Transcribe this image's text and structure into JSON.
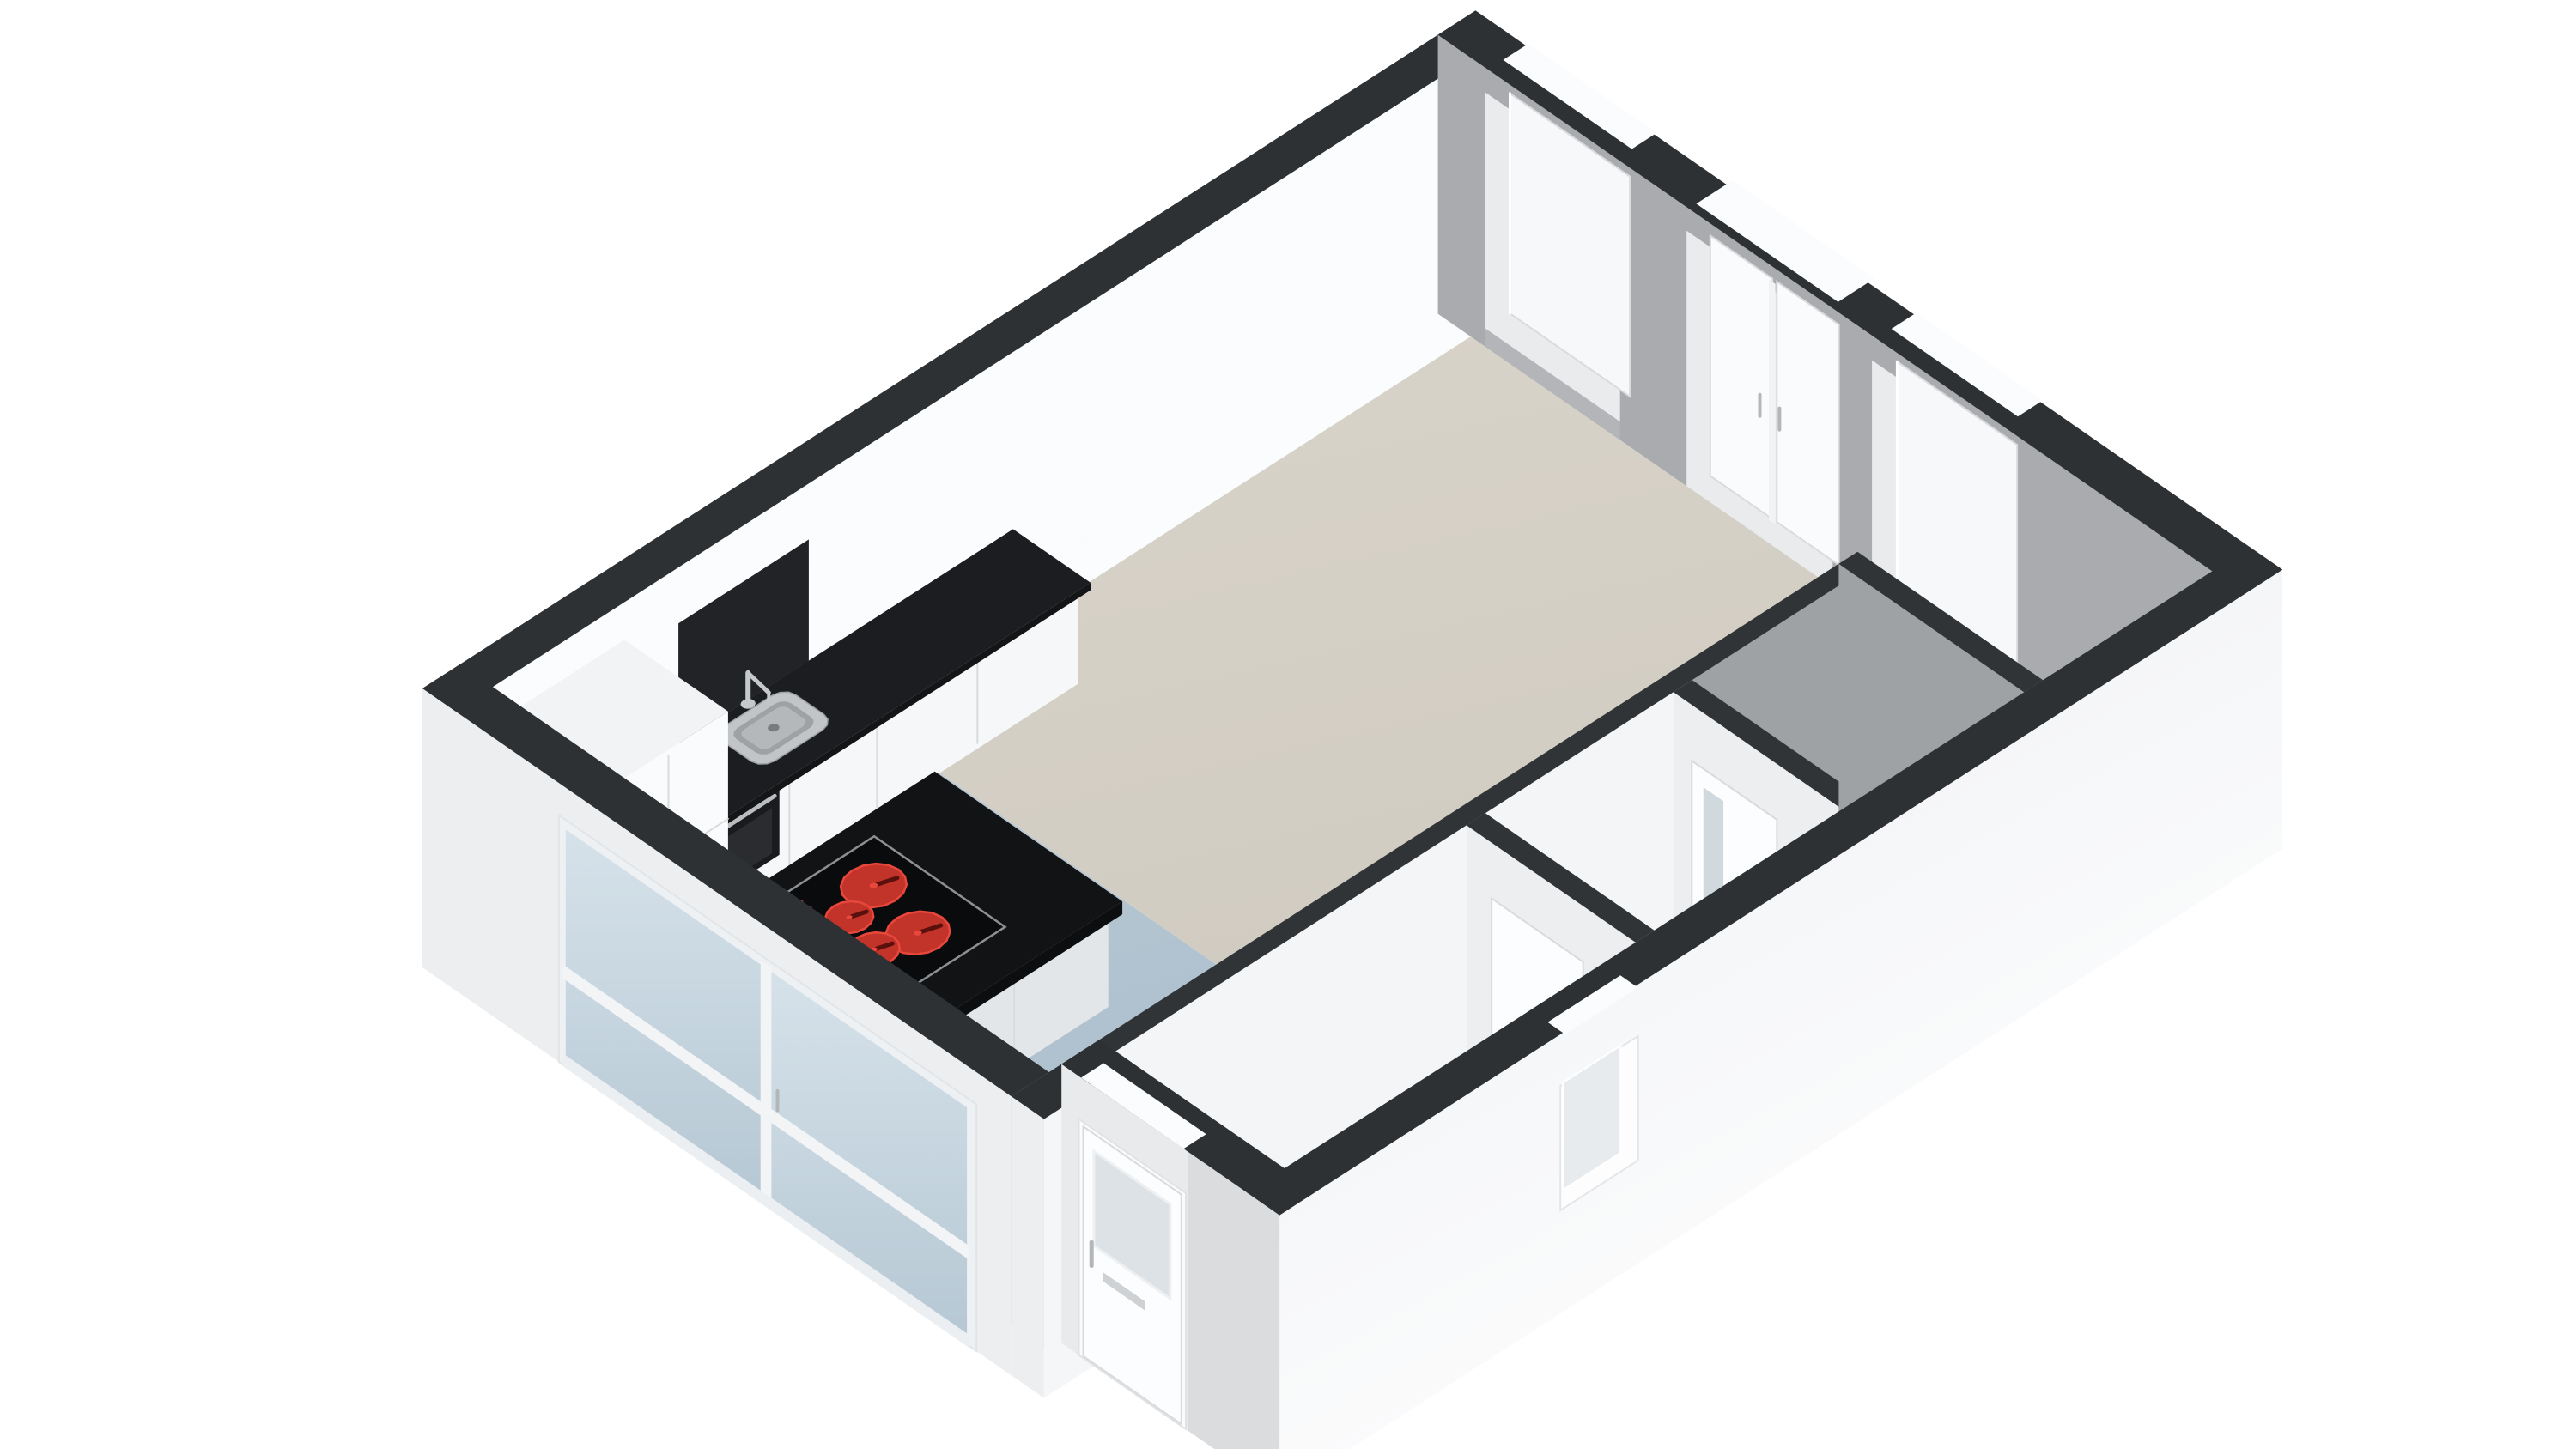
{
  "scene": {
    "type": "3d-floorplan-render",
    "description": "Isometric 3D floor plan of a studio apartment, empty of furniture, white background",
    "rooms": [
      "living-room",
      "kitchen",
      "entrance-hall",
      "toilet",
      "bathroom",
      "alcove"
    ],
    "fixtures": [
      "kitchen-island",
      "ceramic-cooktop",
      "sink",
      "faucet",
      "built-in-oven",
      "kitchen-counter",
      "tall-cabinet",
      "washing-machine",
      "low-cabinet"
    ],
    "openings": [
      "entrance-door",
      "sliding-glass-doors",
      "french-doors",
      "window-1",
      "window-2",
      "small-window",
      "interior-door-1",
      "interior-door-2"
    ]
  },
  "colors": {
    "background": "#ffffff",
    "cap": "#2e3133",
    "capInt": "#313437",
    "extWhiteF": "#eceef0",
    "extLightE": "#f4f6f8",
    "extDoorWallD": "#e8eaec",
    "doorWallShade": "#dadcde",
    "innerWhiteA": "#fbfcfd",
    "grayInner": "#a9abae",
    "grayPanel": "#b3b5b8",
    "grayBath": "#9fa2a5",
    "intWhiteG": "#f4f5f7",
    "intWhite2": "#eceef0",
    "living1": "#d9d4ca",
    "living2": "#cfcabf",
    "kitchen1": "#bccbd6",
    "kitchen2": "#a9bdcb",
    "floorHall": "#e8e7e3",
    "floorToilet": "#edeeef",
    "floorBath": "#eaecee",
    "wallC1": "#edeff2",
    "wallC2": "#ffffff",
    "counterBlack": "#1c1d20",
    "counterEdge": "#141517",
    "backsplash": "#212326",
    "cabWhite": "#f6f7f9",
    "cabSeam": "#d9dbde",
    "cabEnd": "#e8eaec",
    "tallTop": "#f2f3f5",
    "tallFace": "#fafbfc",
    "tallSide": "#e7e9eb",
    "islandTop": "#121315",
    "islandEdgeX": "#0d0e10",
    "islandEdgeY": "#17181b",
    "islandFaceX": "#e3e6e9",
    "islandFaceY": "#f5f6f8",
    "cooktop": "#0a0b0d",
    "cooktopFrame": "#8d9093",
    "burner": "#c2332a",
    "burnerRing": "#e8473c",
    "burnerDark": "#5a110d",
    "steel": "#c2c5c8",
    "steelDark": "#9ea2a5",
    "drain": "#787c7f",
    "faucet": "#c6c9cc",
    "oven": "#1a1b1e",
    "ovenGlass": "#2a2c30",
    "ovenHandle": "#babdc0",
    "doorWhite": "#fcfdfe",
    "doorStroke": "#d8dadd",
    "frost": "#dde2e6",
    "letterbox": "#cfd2d4",
    "handle": "#b4b7ba",
    "glassWin": "#f6f8f9",
    "glassFrench": "#fafbfc",
    "frameWhite": "#e9ebec",
    "notchWhite": "#fbfcfd",
    "glassSlide1": "#d6e2ea",
    "glassSlide2": "#b6c8d4",
    "railWhite": "#f2f4f6",
    "liteGlass": "#cfd9de",
    "washerTop": "#f0f1f3",
    "washerX": "#e2e4e6",
    "washerY": "#f8f9fa",
    "beigeTop": "#e3dac6",
    "beigeX": "#cdc3ab",
    "beigeY": "#dcd2bc",
    "smallWinGlass": "#e8ebed"
  }
}
